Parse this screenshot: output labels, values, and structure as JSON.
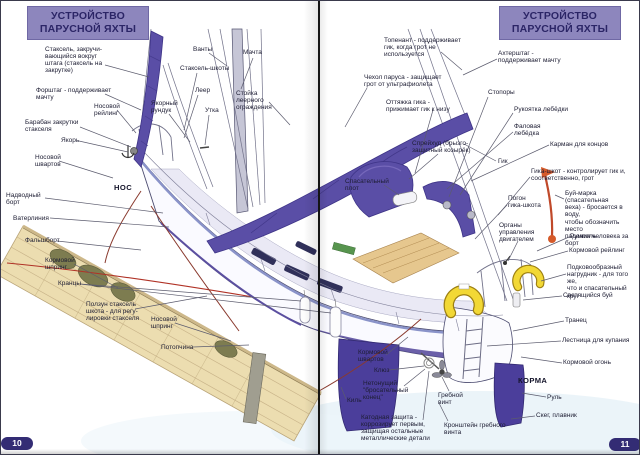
{
  "page": {
    "header_title": "УСТРОЙСТВО\nПАРУСНОЙ ЯХТЫ",
    "left_page_number": "10",
    "right_page_number": "11"
  },
  "colors": {
    "header_bg": "#8d86bd",
    "header_text": "#2b2566",
    "page_pill_bg": "#332c74",
    "sail_purple": "#5a4ea6",
    "hull_bottom_purple": "#4b3e9b",
    "dock_tan": "#ecddb0",
    "buoy_yellow": "#f2d835",
    "danbuoy_orange": "#d55a2a",
    "label_text": "#1d1d33",
    "leader_line": "#5c5c6e"
  },
  "labels": [
    {
      "text": "Стаксель, закручи-\nвающийся вокруг\nштага (стаксель на\nзакрутке)",
      "x": 44,
      "y": 45,
      "lines": [
        [
          104,
          64,
          148,
          76
        ]
      ]
    },
    {
      "text": "Форштаг - поддерживает\nмачту",
      "x": 35,
      "y": 86,
      "lines": [
        [
          104,
          93,
          140,
          109
        ]
      ]
    },
    {
      "text": "Носовой\nрейлинг",
      "x": 93,
      "y": 102,
      "lines": [
        [
          116,
          109,
          135,
          132
        ]
      ]
    },
    {
      "text": "Барабан закрутки\nстакселя",
      "x": 24,
      "y": 118,
      "lines": [
        [
          79,
          126,
          130,
          146
        ]
      ]
    },
    {
      "text": "Якорь",
      "x": 60,
      "y": 136,
      "lines": [
        [
          78,
          140,
          127,
          151
        ]
      ]
    },
    {
      "text": "Носовой\nшвартов",
      "x": 34,
      "y": 153,
      "lines": [
        [
          58,
          160,
          112,
          177
        ]
      ]
    },
    {
      "text": "НОС",
      "x": 113,
      "y": 183,
      "bold": true,
      "lines": []
    },
    {
      "text": "Надводный\nборт",
      "x": 5,
      "y": 191,
      "lines": [
        [
          44,
          197,
          162,
          212
        ]
      ]
    },
    {
      "text": "Ватерлиния",
      "x": 12,
      "y": 214,
      "lines": [
        [
          49,
          217,
          168,
          226
        ]
      ]
    },
    {
      "text": "Фальшборт",
      "x": 24,
      "y": 236,
      "lines": [
        [
          56,
          240,
          140,
          249
        ]
      ]
    },
    {
      "text": "Кормовой\nшпринг",
      "x": 44,
      "y": 256,
      "lines": [
        [
          73,
          263,
          117,
          287
        ]
      ]
    },
    {
      "text": "Кранцы",
      "x": 57,
      "y": 279,
      "lines": [
        [
          79,
          283,
          300,
          300
        ],
        [
          79,
          283,
          330,
          312
        ]
      ]
    },
    {
      "text": "Ползун стаксель\nшкота - для регу-\nлировки стакселя",
      "x": 85,
      "y": 300,
      "lines": [
        [
          134,
          308,
          206,
          295
        ]
      ]
    },
    {
      "text": "Носовой\nшпринг",
      "x": 150,
      "y": 315,
      "lines": [
        [
          174,
          322,
          230,
          340
        ]
      ]
    },
    {
      "text": "Потопчина",
      "x": 160,
      "y": 343,
      "lines": [
        [
          192,
          346,
          248,
          344
        ]
      ]
    },
    {
      "text": "Якорный\nрундук",
      "x": 150,
      "y": 99,
      "lines": [
        [
          168,
          113,
          189,
          141
        ]
      ]
    },
    {
      "text": "Стаксель-шкоты",
      "x": 179,
      "y": 64,
      "lines": [
        [
          196,
          72,
          183,
          129
        ]
      ]
    },
    {
      "text": "Ванты",
      "x": 192,
      "y": 45,
      "lines": [
        [
          208,
          52,
          226,
          65
        ]
      ]
    },
    {
      "text": "Леер",
      "x": 194,
      "y": 86,
      "lines": [
        [
          197,
          94,
          183,
          137
        ]
      ]
    },
    {
      "text": "Утка",
      "x": 204,
      "y": 106,
      "lines": [
        [
          208,
          114,
          204,
          144
        ]
      ]
    },
    {
      "text": "Мачта",
      "x": 242,
      "y": 48,
      "lines": [
        [
          252,
          57,
          240,
          88
        ]
      ]
    },
    {
      "text": "Стойка\nлеерного\nограждения",
      "x": 235,
      "y": 89,
      "lines": [
        [
          268,
          101,
          289,
          124
        ]
      ]
    },
    {
      "text": "Топенант - поддерживает\nгик, когда грот не\nиспользуется",
      "x": 383,
      "y": 36,
      "lines": [
        [
          440,
          51,
          461,
          69
        ]
      ]
    },
    {
      "text": "Ахтерштаг -\nподдерживает мачту",
      "x": 497,
      "y": 49,
      "lines": [
        [
          496,
          58,
          462,
          74
        ]
      ]
    },
    {
      "text": "Чехол паруса - защищает\nгрот от ультрафиолета",
      "x": 363,
      "y": 73,
      "lines": [
        [
          366,
          87,
          344,
          126
        ]
      ]
    },
    {
      "text": "Стопоры",
      "x": 487,
      "y": 88,
      "lines": [
        [
          487,
          96,
          448,
          196
        ]
      ]
    },
    {
      "text": "Оттяжка гика -\nприжимает гик к низу",
      "x": 385,
      "y": 98,
      "lines": [
        [
          432,
          109,
          414,
          172
        ]
      ]
    },
    {
      "text": "Рукоятка лебёдки",
      "x": 513,
      "y": 105,
      "lines": [
        [
          512,
          112,
          459,
          194
        ]
      ]
    },
    {
      "text": "Фаловая\nлебёдка",
      "x": 513,
      "y": 122,
      "lines": [
        [
          512,
          131,
          446,
          188
        ]
      ]
    },
    {
      "text": "Карман для концов",
      "x": 549,
      "y": 140,
      "lines": [
        [
          548,
          144,
          470,
          180
        ]
      ]
    },
    {
      "text": "Спрейхуд (брызго-\nзащитный козырёк)",
      "x": 411,
      "y": 139,
      "lines": [
        [
          437,
          153,
          408,
          178
        ]
      ]
    },
    {
      "text": "Гик",
      "x": 497,
      "y": 157,
      "lines": [
        [
          495,
          160,
          463,
          143
        ]
      ]
    },
    {
      "text": "Гика-шкот - контролирует гик и,\nсоответственно, грот",
      "x": 530,
      "y": 167,
      "lines": [
        [
          529,
          176,
          497,
          214
        ]
      ]
    },
    {
      "text": "Спасательный\nплот",
      "x": 344,
      "y": 177,
      "lines": [
        [
          383,
          184,
          398,
          194
        ]
      ]
    },
    {
      "text": "Погон\nгика-шкота",
      "x": 507,
      "y": 194,
      "lines": [
        [
          506,
          204,
          474,
          238
        ]
      ]
    },
    {
      "text": "Буй-марка (спасательная\nвеха) - бросается в воду,\nчтобы обозначить место\nпадения человека за борт",
      "x": 564,
      "y": 189,
      "lines": [
        [
          563,
          198,
          554,
          194
        ]
      ]
    },
    {
      "text": "Органы\nуправления\nдвигателем",
      "x": 498,
      "y": 221,
      "lines": [
        [
          517,
          240,
          507,
          260
        ]
      ]
    },
    {
      "text": "Румпель",
      "x": 569,
      "y": 232,
      "lines": [
        [
          568,
          236,
          536,
          250
        ]
      ]
    },
    {
      "text": "Кормовой рейлинг",
      "x": 568,
      "y": 246,
      "lines": [
        [
          567,
          250,
          529,
          261
        ]
      ]
    },
    {
      "text": "Подковообразный\nнагрудник - для того же,\nчто и спасательный круг",
      "x": 566,
      "y": 263,
      "lines": [
        [
          565,
          273,
          540,
          280
        ]
      ]
    },
    {
      "text": "Светящийся буй",
      "x": 562,
      "y": 291,
      "lines": [
        [
          561,
          295,
          522,
          299
        ]
      ]
    },
    {
      "text": "Транец",
      "x": 564,
      "y": 316,
      "lines": [
        [
          563,
          320,
          512,
          330
        ]
      ]
    },
    {
      "text": "Лестница для купания",
      "x": 561,
      "y": 336,
      "lines": [
        [
          560,
          340,
          486,
          345
        ]
      ]
    },
    {
      "text": "Кормовой огонь",
      "x": 562,
      "y": 358,
      "lines": [
        [
          561,
          362,
          520,
          356
        ]
      ]
    },
    {
      "text": "КОРМА",
      "x": 517,
      "y": 376,
      "bold": true,
      "lines": []
    },
    {
      "text": "Руль",
      "x": 546,
      "y": 393,
      "lines": [
        [
          545,
          396,
          521,
          392
        ]
      ]
    },
    {
      "text": "Скег, плавник",
      "x": 535,
      "y": 411,
      "lines": [
        [
          534,
          415,
          510,
          418
        ]
      ]
    },
    {
      "text": "Кормовой\nшвартов",
      "x": 357,
      "y": 348,
      "lines": [
        [
          385,
          354,
          407,
          336
        ]
      ]
    },
    {
      "text": "Клюз",
      "x": 373,
      "y": 366,
      "lines": [
        [
          388,
          369,
          423,
          365
        ]
      ]
    },
    {
      "text": "Киль",
      "x": 346,
      "y": 396,
      "lines": [
        [
          345,
          398,
          340,
          386
        ]
      ]
    },
    {
      "text": "Нетонущий\n\"бросательный\nконец\"",
      "x": 362,
      "y": 379,
      "lines": [
        [
          403,
          385,
          424,
          368
        ]
      ]
    },
    {
      "text": "Гребной\nвинт",
      "x": 437,
      "y": 391,
      "lines": [
        [
          448,
          390,
          441,
          376
        ]
      ]
    },
    {
      "text": "Катодная защита -\nкоррозирует первым,\nзащищая остальные\nметаллические детали",
      "x": 360,
      "y": 413,
      "lines": [
        [
          422,
          419,
          428,
          370
        ]
      ]
    },
    {
      "text": "Кронштейн гребного\nвинта",
      "x": 443,
      "y": 421,
      "lines": [
        [
          447,
          420,
          438,
          402
        ]
      ]
    }
  ]
}
